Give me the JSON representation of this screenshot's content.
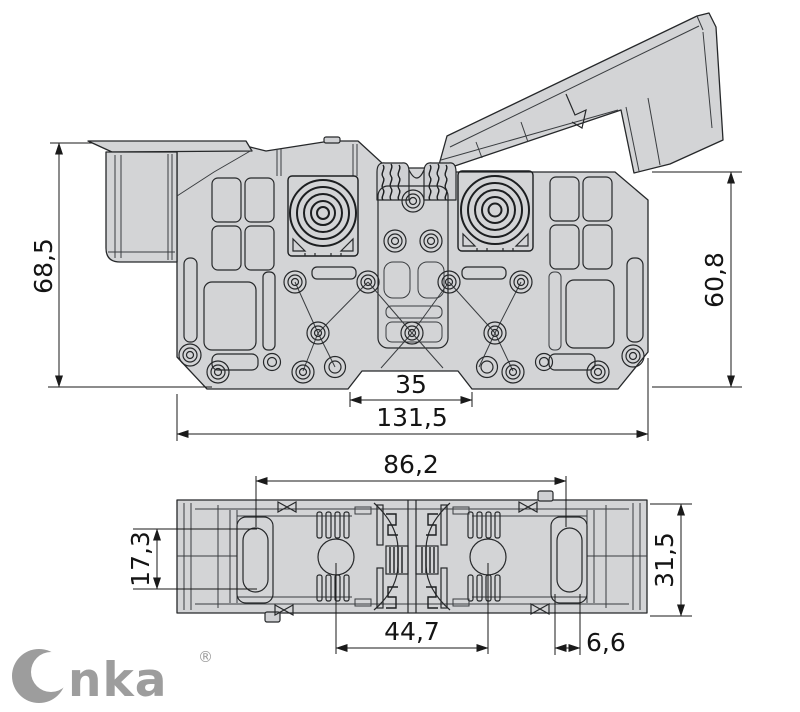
{
  "colors": {
    "background": "#ffffff",
    "body_fill": "#d3d4d6",
    "outline": "#26282a",
    "dimension_lines": "#1a1a1a",
    "logo_grey": "#9d9d9d"
  },
  "side_view": {
    "dims": {
      "overall_height": "68,5",
      "right_height": "60,8",
      "notch_width": "35",
      "overall_width": "131,5"
    }
  },
  "top_view": {
    "dims": {
      "slot_span": "86,2",
      "slot_length": "17,3",
      "depth": "31,5",
      "inner_span": "44,7",
      "slot_width": "6,6"
    }
  },
  "logo": {
    "brand": "Onka",
    "rest": "nka",
    "registered": "®"
  }
}
